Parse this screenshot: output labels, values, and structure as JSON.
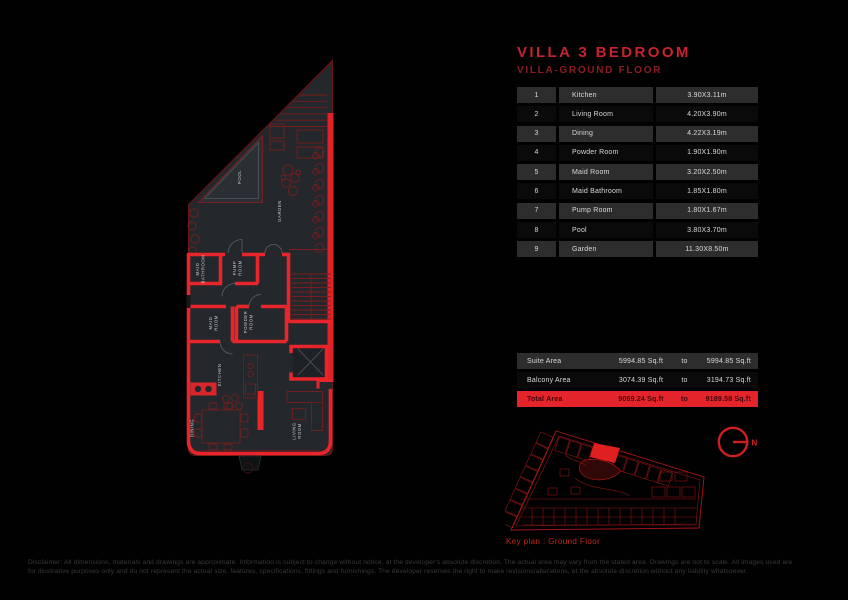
{
  "header": {
    "title": "VILLA 3 BEDROOM",
    "subtitle": "VILLA-GROUND FLOOR"
  },
  "room_table": {
    "rows": [
      {
        "num": "1",
        "name": "Kitchen",
        "dim": "3.90X3.11m"
      },
      {
        "num": "2",
        "name": "Living Room",
        "dim": "4.20X3.90m"
      },
      {
        "num": "3",
        "name": "Dining",
        "dim": "4.22X3.19m"
      },
      {
        "num": "4",
        "name": "Powder Room",
        "dim": "1.90X1.90m"
      },
      {
        "num": "5",
        "name": "Maid Room",
        "dim": "3.20X2.50m"
      },
      {
        "num": "6",
        "name": "Maid Bathroom",
        "dim": "1.85X1.80m"
      },
      {
        "num": "7",
        "name": "Pump Room",
        "dim": "1.80X1.67m"
      },
      {
        "num": "8",
        "name": "Pool",
        "dim": "3.80X3.70m"
      },
      {
        "num": "9",
        "name": "Garden",
        "dim": "11.30X8.50m"
      }
    ]
  },
  "area_table": {
    "rows": [
      {
        "label": "Suite Area",
        "from": "5994.85 Sq.ft",
        "to_word": "to",
        "to": "5994.85 Sq.ft",
        "highlight": false
      },
      {
        "label": "Balcony Area",
        "from": "3074.39 Sq.ft",
        "to_word": "to",
        "to": "3194.73 Sq.ft",
        "highlight": false
      },
      {
        "label": "Total Area",
        "from": "9069.24 Sq.ft",
        "to_word": "to",
        "to": "9189.58 Sq.ft",
        "highlight": true
      }
    ]
  },
  "floor_plan": {
    "labels": {
      "pool": "POOL",
      "garden": "GARDEN",
      "maid_bathroom_1": "MAID",
      "maid_bathroom_2": "BATHROOM",
      "pump_room_1": "PUMP",
      "pump_room_2": "ROOM",
      "maid_room_1": "MAID",
      "maid_room_2": "ROOM",
      "powder_room_1": "POWDER",
      "powder_room_2": "ROOM",
      "kitchen": "KITCHEN",
      "dining": "DINING",
      "living_room_1": "LIVING",
      "living_room_2": "ROOM"
    }
  },
  "key_plan": {
    "caption": "Key plan : Ground Floor"
  },
  "compass": {
    "north_label": "N"
  },
  "disclaimer": {
    "line1": "Disclaimer: All dimensions, materials and drawings are approximate. Information is subject to change without notice, at the developer's absolute discretion. The actual area may vary from the stated area. Drawings are not to scale. All images used are",
    "line2": "for illustrative purposes only and do not represent the actual size, features, specifications, fittings and furnishings. The developer reserves the right to make revisions/alterations, at the absolute discretion without any liability whatsoever."
  },
  "colors": {
    "accent_red": "#c62332",
    "dark_red": "#8e1b22",
    "wall_red": "#e8252b",
    "line_red": "#7a1d1d",
    "furniture_red": "#6f2020",
    "row_dark": "#2d2d2d",
    "row_black": "#0a0a0a",
    "highlight_red": "#e3242b",
    "text_light": "#d9d9d9",
    "plan_fill": "#24282c"
  }
}
